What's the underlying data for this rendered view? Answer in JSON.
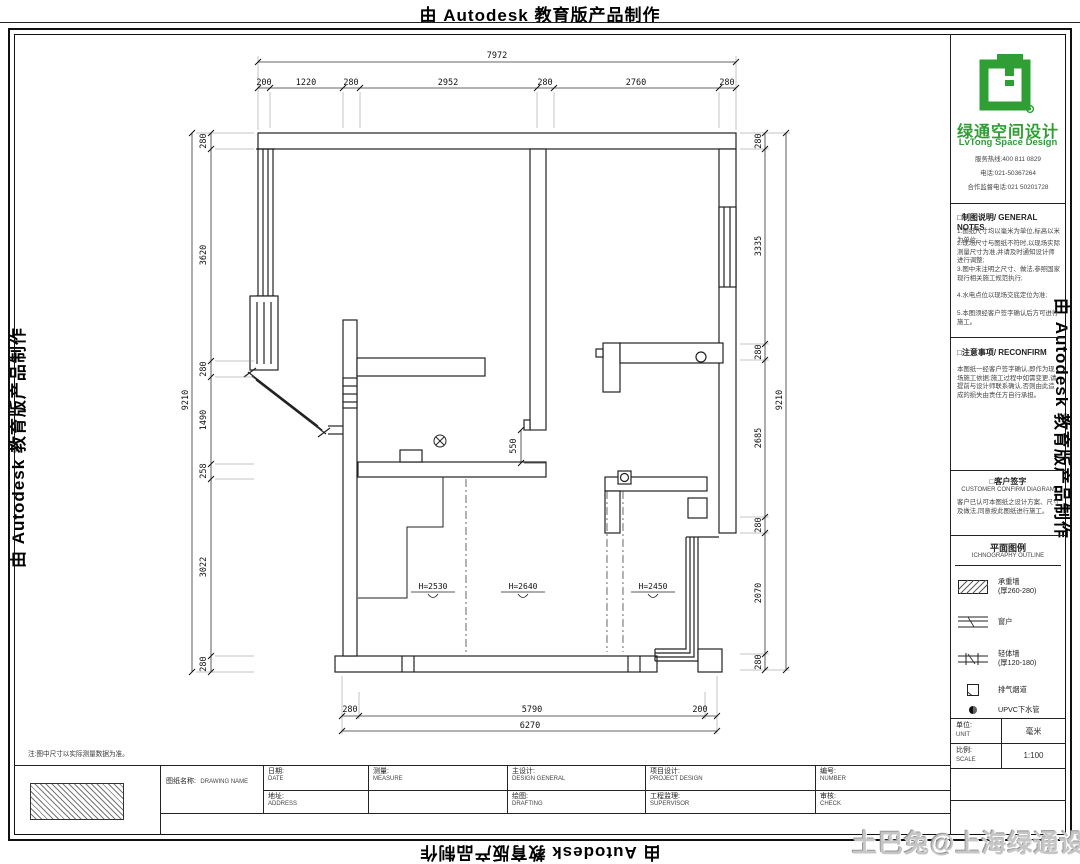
{
  "banner": {
    "text": "由 Autodesk 教育版产品制作"
  },
  "watermark": {
    "text": "土巴兔@上海绿通设计"
  },
  "brand": {
    "name_zh": "绿通空间设计",
    "name_en": "LvTong Space Design",
    "accent_green": "#2f9e35",
    "contact_lines": [
      "服务热线:400 811 0829",
      "电话:021-50367264",
      "合作监督电话:021 50201728"
    ]
  },
  "sections": {
    "notes": {
      "title": "□制图说明/ GENERAL NOTES",
      "lines": [
        "1.图纸尺寸均以毫米为单位,标高以米为单位;",
        "2.现场尺寸与图纸不符时,以现场实际测量尺寸为准,并请及时通知设计师进行调整;",
        "3.图中未注明之尺寸、做法,参照国家现行相关施工规范执行;",
        "4.水电点位以现场交底定位为准;",
        "5.本图须经客户签字确认后方可进行施工。"
      ]
    },
    "reconfirm": {
      "title": "□注意事项/ RECONFIRM",
      "body": "本图纸一经客户签字确认,即作为现场施工依据;施工过程中如需变更,请提前与设计师联系确认,否则由此造成的损失由责任方自行承担。"
    },
    "sign": {
      "title_zh": "□客户签字",
      "title_en": "CUSTOMER CONFIRM DIAGRAM",
      "body": "客户已认可本图纸之设计方案、尺寸及做法,同意按此图纸进行施工。"
    }
  },
  "legend": {
    "title_zh": "平面图例",
    "title_en": "ICHNOGRAPHY OUTLINE",
    "items": [
      {
        "label": "承重墙",
        "sub": "(厚260-280)"
      },
      {
        "label": "窗户",
        "sub": ""
      },
      {
        "label": "轻体墙",
        "sub": "(厚120-180)"
      },
      {
        "label": "排气烟道",
        "sub": ""
      },
      {
        "label": "UPVC下水管",
        "sub": ""
      }
    ]
  },
  "panel_table": {
    "rows": [
      {
        "zh": "单位:",
        "en": "UNIT",
        "value": "毫米"
      },
      {
        "zh": "比例:",
        "en": "SCALE",
        "value": "1:100"
      }
    ]
  },
  "title_block": {
    "name_zh": "图纸名称:",
    "name_en": "DRAWING NAME",
    "row1": [
      {
        "zh": "日期:",
        "en": "DATE"
      },
      {
        "zh": "测量:",
        "en": "MEASURE"
      },
      {
        "zh": "主设计:",
        "en": "DESIGN GENERAL"
      },
      {
        "zh": "项目设计:",
        "en": "PROJECT DESIGN"
      },
      {
        "zh": "编号:",
        "en": "NUMBER"
      }
    ],
    "row2": [
      {
        "zh": "地址:",
        "en": "ADDRESS"
      },
      {
        "zh": "",
        "en": ""
      },
      {
        "zh": "绘图:",
        "en": "DRAFTING"
      },
      {
        "zh": "工程监理:",
        "en": "SUPERVISOR"
      },
      {
        "zh": "审核:",
        "en": "CHECK"
      }
    ]
  },
  "footnote": "注:图中尺寸以实际测量数据为准。",
  "plan": {
    "dims_top": {
      "total": "7972",
      "segments": [
        "200",
        "1220",
        "280",
        "2952",
        "280",
        "2760",
        "280"
      ]
    },
    "dims_left": {
      "total": "9210",
      "segments": [
        "280",
        "3620",
        "280",
        "1490",
        "258",
        "3022",
        "280"
      ]
    },
    "dims_right": {
      "total": "9210",
      "segments": [
        "280",
        "3335",
        "280",
        "2685",
        "280",
        "2070",
        "280"
      ]
    },
    "dims_bottom": {
      "total": "6270",
      "segments": [
        "280",
        "5790",
        "200"
      ]
    },
    "opening_dim": "550",
    "ceiling_heights": [
      "H=2530",
      "H=2640",
      "H=2450"
    ]
  }
}
